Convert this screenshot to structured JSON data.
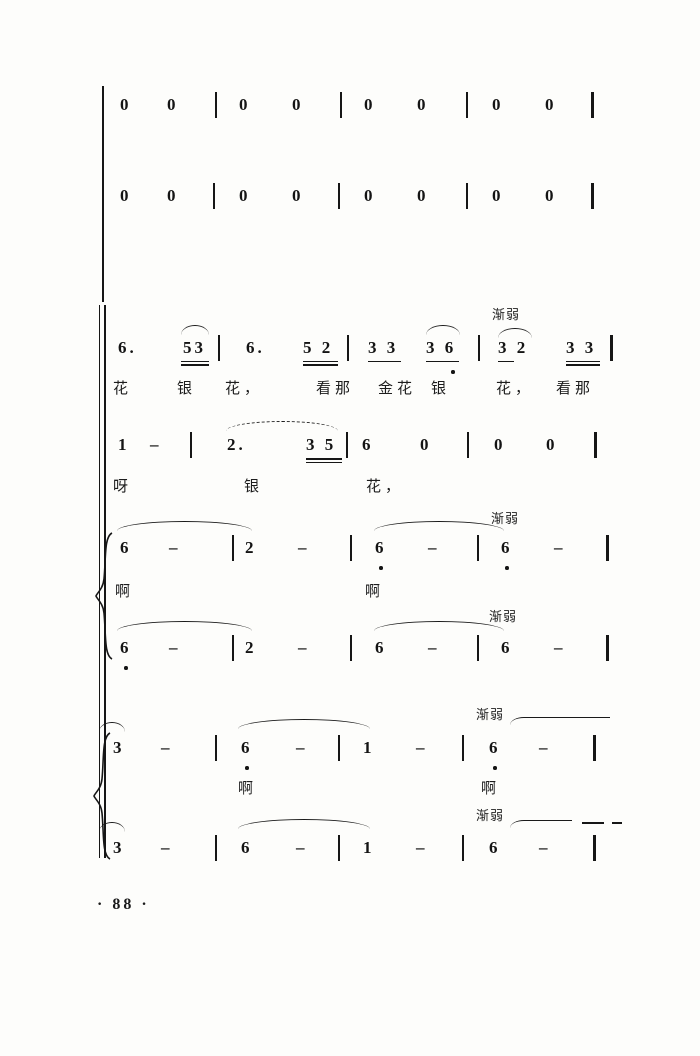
{
  "dynamics_label": "渐弱",
  "footer_page_number": "· 88 ·",
  "staves": {
    "rest_row_1": [
      "0",
      "0",
      "0",
      "0",
      "0",
      "0",
      "0",
      "0"
    ],
    "rest_row_2": [
      "0",
      "0",
      "0",
      "0",
      "0",
      "0",
      "0",
      "0"
    ],
    "melody_row_1": [
      "6.",
      "53",
      "6.",
      "5 2",
      "3 3",
      "3 6",
      "3 2",
      "3 3"
    ],
    "lyrics_row_1": [
      "花",
      "银",
      "花，",
      "看那",
      "金花",
      "银",
      "花，",
      "看那"
    ],
    "melody_row_2": [
      "1",
      "–",
      "2.",
      "3 5",
      "6",
      "0",
      "0",
      "0"
    ],
    "lyrics_row_2": [
      "呀",
      "银",
      "花，"
    ],
    "harmony_upper_a": [
      "6",
      "–",
      "2",
      "–",
      "6",
      "–",
      "6",
      "–"
    ],
    "harmony_lyrics_a": [
      "啊",
      "啊"
    ],
    "harmony_lower_a": [
      "6",
      "–",
      "2",
      "–",
      "6",
      "–",
      "6",
      "–"
    ],
    "harmony_upper_b": [
      "3",
      "–",
      "6",
      "–",
      "1",
      "–",
      "6",
      "–"
    ],
    "harmony_lyrics_b": [
      "啊",
      "啊"
    ],
    "harmony_lower_b": [
      "3",
      "–",
      "6",
      "–",
      "1",
      "–",
      "6",
      "–"
    ]
  }
}
